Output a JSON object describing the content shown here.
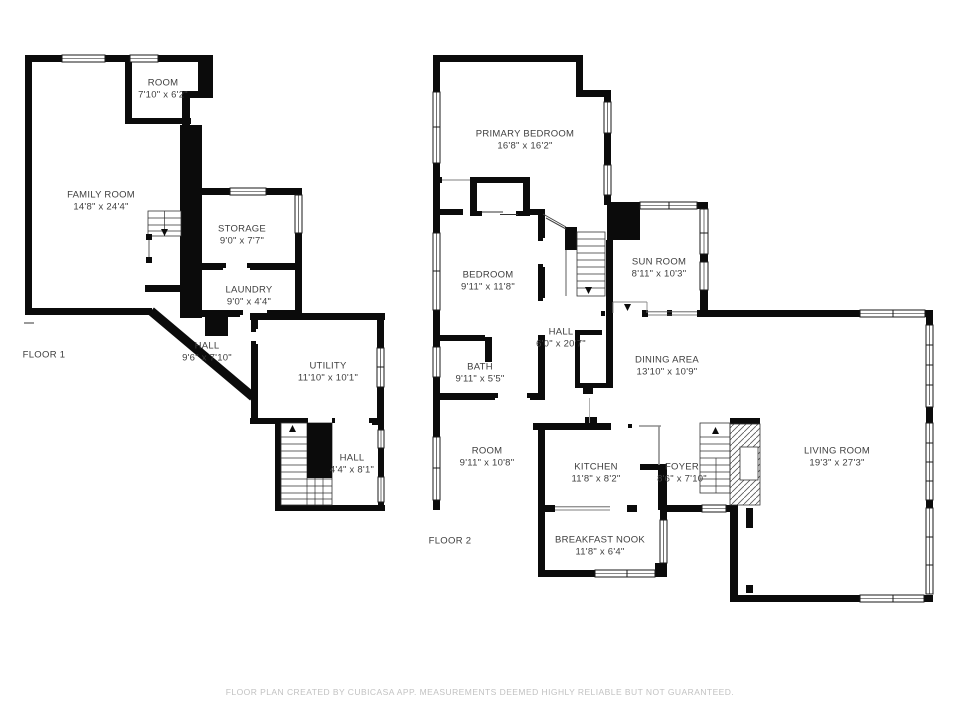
{
  "document": {
    "type": "floor-plan",
    "creator_note": "FLOOR PLAN CREATED BY CUBICASA APP. MEASUREMENTS DEEMED HIGHLY RELIABLE BUT NOT GUARANTEED."
  },
  "colors": {
    "wall": "#0b0b0b",
    "background": "#ffffff",
    "label_text": "#3e3e3e",
    "footer_text": "#c2c2c2",
    "thin_line": "#777777"
  },
  "floor1": {
    "label": "FLOOR 1",
    "rooms": {
      "room": {
        "name": "ROOM",
        "dims": "7'10\" x 6'2\""
      },
      "family_room": {
        "name": "FAMILY ROOM",
        "dims": "14'8\" x 24'4\""
      },
      "storage": {
        "name": "STORAGE",
        "dims": "9'0\" x 7'7\""
      },
      "laundry": {
        "name": "LAUNDRY",
        "dims": "9'0\" x 4'4\""
      },
      "hall_upper": {
        "name": "HALL",
        "dims": "9'6\" x 7'10\""
      },
      "utility": {
        "name": "UTILITY",
        "dims": "11'10\" x 10'1\""
      },
      "hall_lower": {
        "name": "HALL",
        "dims": "4'4\" x 8'1\""
      }
    }
  },
  "floor2": {
    "label": "FLOOR 2",
    "rooms": {
      "primary_bedroom": {
        "name": "PRIMARY BEDROOM",
        "dims": "16'8\" x 16'2\""
      },
      "bedroom": {
        "name": "BEDROOM",
        "dims": "9'11\" x 11'8\""
      },
      "sun_room": {
        "name": "SUN ROOM",
        "dims": "8'11\" x 10'3\""
      },
      "hall": {
        "name": "HALL",
        "dims": "6'0\" x 20'7\""
      },
      "bath": {
        "name": "BATH",
        "dims": "9'11\" x 5'5\""
      },
      "dining_area": {
        "name": "DINING AREA",
        "dims": "13'10\" x 10'9\""
      },
      "room": {
        "name": "ROOM",
        "dims": "9'11\" x 10'8\""
      },
      "kitchen": {
        "name": "KITCHEN",
        "dims": "11'8\" x 8'2\""
      },
      "foyer": {
        "name": "FOYER",
        "dims": "8'6\" x 7'10\""
      },
      "living_room": {
        "name": "LIVING ROOM",
        "dims": "19'3\" x 27'3\""
      },
      "breakfast_nook": {
        "name": "BREAKFAST NOOK",
        "dims": "11'8\" x 6'4\""
      }
    }
  }
}
